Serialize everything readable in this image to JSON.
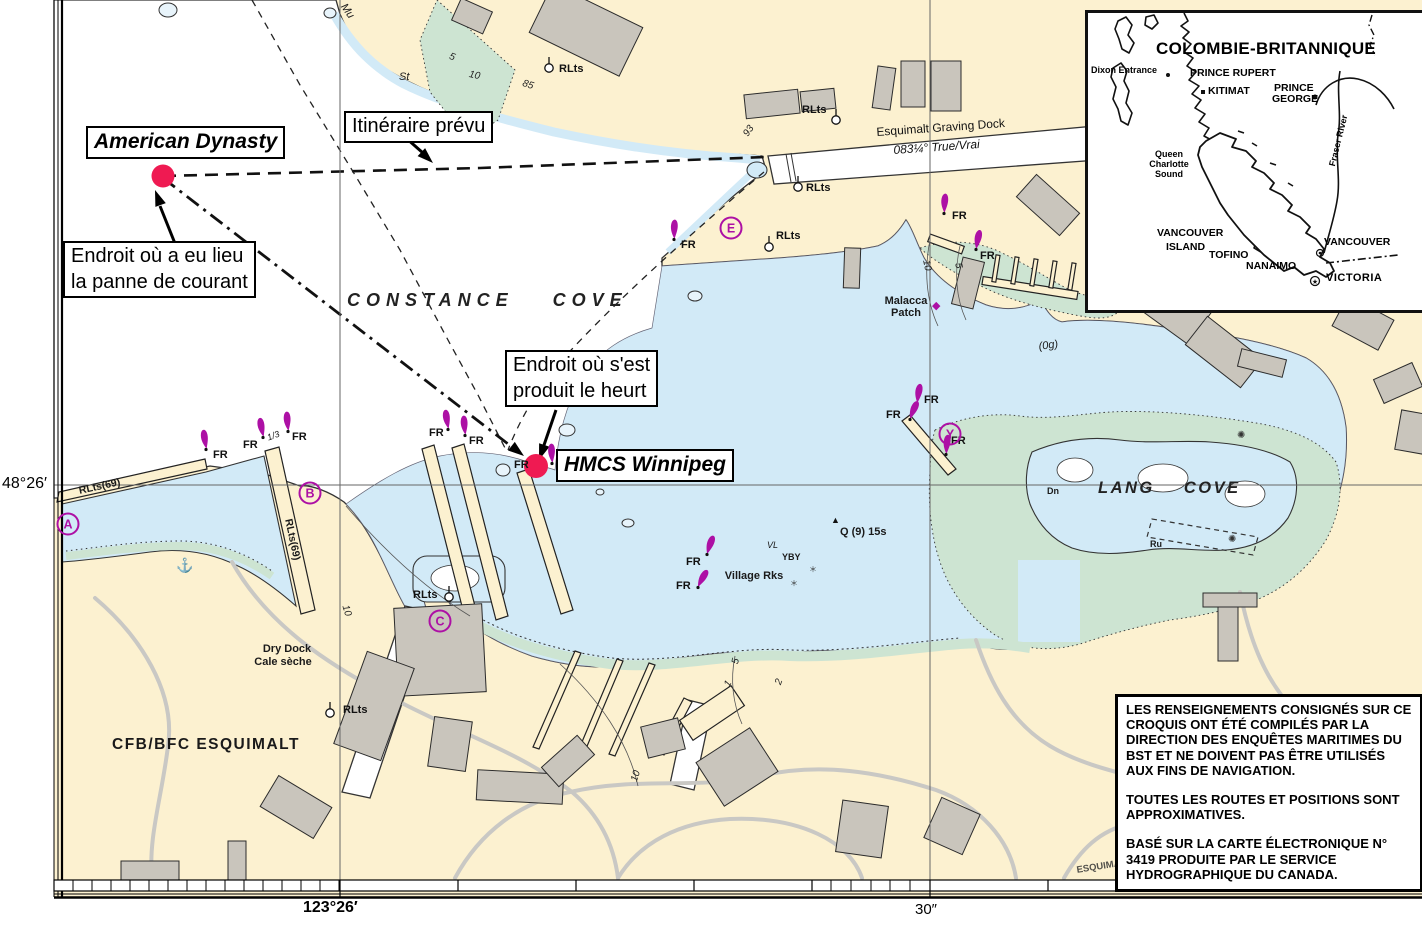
{
  "colors": {
    "land": "#fcf1d0",
    "water_deep": "#ffffff",
    "water_shallow": "#d2eaf7",
    "tidal_green": "#cde4d2",
    "building": "#c9c5bc",
    "road": "#c9c8c4",
    "magenta": "#ad10a5",
    "incident_red": "#ef1a52",
    "ink": "#111111"
  },
  "annotations": {
    "american_dynasty": "American Dynasty",
    "itineraire": "Itinéraire prévu",
    "panne": {
      "line1": "Endroit où a eu lieu",
      "line2": "la panne de courant"
    },
    "heurt": {
      "line1": "Endroit où s'est",
      "line2": "produit le heurt"
    },
    "hmcs": "HMCS Winnipeg"
  },
  "axis": {
    "lat": "48°26′",
    "lon": "123°26′",
    "sec": "30″"
  },
  "map_labels": [
    {
      "t": "CONSTANCE COVE",
      "x": 347,
      "y": 291,
      "cls": "cove1"
    },
    {
      "t": "LANG COVE",
      "x": 1098,
      "y": 480,
      "cls": "cove2"
    },
    {
      "t": "Esquimalt Graving Dock",
      "x": 876,
      "y": 126,
      "cls": "dockname",
      "rot": -4
    },
    {
      "t": "083¼°  True/Vrai",
      "x": 893,
      "y": 144,
      "cls": "dockbear",
      "rot": -4
    },
    {
      "t": "Malacca",
      "x": 906,
      "y": 296,
      "cls": "sb",
      "c": 1
    },
    {
      "t": "Patch",
      "x": 906,
      "y": 308,
      "cls": "sb",
      "c": 1
    },
    {
      "t": "Village Rks",
      "x": 754,
      "y": 571,
      "cls": "sb",
      "c": 1
    },
    {
      "t": "Q (9) 15s",
      "x": 840,
      "y": 527,
      "cls": "sb",
      "rot": 0
    },
    {
      "t": "VL",
      "x": 767,
      "y": 541,
      "cls": "ti"
    },
    {
      "t": "YBY",
      "x": 782,
      "y": 553,
      "cls": "tiny"
    },
    {
      "t": "Dry Dock",
      "x": 287,
      "y": 644,
      "cls": "sb",
      "c": 1
    },
    {
      "t": "Cale sèche",
      "x": 283,
      "y": 657,
      "cls": "sb",
      "c": 1
    },
    {
      "t": "CFB/BFC ESQUIMALT",
      "x": 112,
      "y": 737,
      "cls": "base"
    },
    {
      "t": "Dn",
      "x": 1047,
      "y": 487,
      "cls": "tiny"
    },
    {
      "t": "Ru",
      "x": 1150,
      "y": 540,
      "cls": "tiny"
    },
    {
      "t": "Mu",
      "x": 347,
      "y": 2,
      "cls": "si",
      "rot": 55
    },
    {
      "t": "St",
      "x": 399,
      "y": 72,
      "cls": "si"
    },
    {
      "t": "G",
      "x": 430,
      "y": 114,
      "cls": "si"
    },
    {
      "t": "(0g)",
      "x": 1038,
      "y": 342,
      "cls": "si",
      "rot": -8
    },
    {
      "t": "5",
      "x": 451,
      "y": 52,
      "cls": "depth",
      "rot": 20
    },
    {
      "t": "10",
      "x": 470,
      "y": 70,
      "cls": "depth",
      "rot": 12
    },
    {
      "t": "85",
      "x": 524,
      "y": 79,
      "cls": "depth",
      "rot": 18
    },
    {
      "t": "93",
      "x": 742,
      "y": 133,
      "cls": "depth",
      "rot": -55
    },
    {
      "t": "10",
      "x": 349,
      "y": 604,
      "cls": "depth",
      "rot": 72
    },
    {
      "t": "10",
      "x": 630,
      "y": 780,
      "cls": "depth",
      "rot": -72
    },
    {
      "t": "5",
      "x": 731,
      "y": 663,
      "cls": "depth",
      "rot": -78
    },
    {
      "t": "1",
      "x": 723,
      "y": 684,
      "cls": "depth",
      "rot": -60
    },
    {
      "t": "2",
      "x": 774,
      "y": 683,
      "cls": "depth",
      "rot": -70
    },
    {
      "t": "10",
      "x": 930,
      "y": 259,
      "cls": "depth",
      "rot": 78
    },
    {
      "t": "5",
      "x": 962,
      "y": 262,
      "cls": "depth",
      "rot": 78
    },
    {
      "t": "RLts(69)",
      "x": 78,
      "y": 486,
      "cls": "rltsrot",
      "rot": -12
    },
    {
      "t": "RLts(69)",
      "x": 293,
      "y": 518,
      "cls": "rltsrot",
      "rot": 78
    },
    {
      "t": "1/3",
      "x": 266,
      "y": 434,
      "cls": "ti",
      "rot": -20
    },
    {
      "t": "ESQUIMALT RD",
      "x": 1076,
      "y": 866,
      "cls": "roadlbl",
      "rot": -9
    }
  ],
  "beacons": [
    {
      "label": "FR",
      "x": 206,
      "y": 448,
      "rot": -10,
      "lx": 213,
      "ly": 458
    },
    {
      "label": "FR",
      "x": 263,
      "y": 436,
      "rot": -12,
      "lx": 243,
      "ly": 448
    },
    {
      "label": "FR",
      "x": 288,
      "y": 430,
      "rot": -6,
      "lx": 292,
      "ly": 440
    },
    {
      "label": "FR",
      "x": 448,
      "y": 428,
      "rot": -10,
      "lx": 429,
      "ly": 436
    },
    {
      "label": "FR",
      "x": 465,
      "y": 434,
      "rot": -6,
      "lx": 469,
      "ly": 444
    },
    {
      "label": "FR",
      "x": 552,
      "y": 462,
      "rot": -4,
      "lx": 514,
      "ly": 468
    },
    {
      "label": "FR",
      "x": 674,
      "y": 238,
      "rot": 0,
      "lx": 681,
      "ly": 248
    },
    {
      "label": "FR",
      "x": 944,
      "y": 212,
      "rot": 2,
      "lx": 952,
      "ly": 219
    },
    {
      "label": "FR",
      "x": 976,
      "y": 248,
      "rot": 10,
      "lx": 980,
      "ly": 259
    },
    {
      "label": "FR",
      "x": 917,
      "y": 402,
      "rot": 8,
      "lx": 924,
      "ly": 403
    },
    {
      "label": "FR",
      "x": 910,
      "y": 418,
      "rot": 22,
      "lx": 886,
      "ly": 418
    },
    {
      "label": "FR",
      "x": 946,
      "y": 453,
      "rot": 4,
      "lx": 951,
      "ly": 444
    },
    {
      "label": "FR",
      "x": 707,
      "y": 553,
      "rot": 18,
      "lx": 686,
      "ly": 565
    },
    {
      "label": "FR",
      "x": 698,
      "y": 586,
      "rot": 28,
      "lx": 676,
      "ly": 589
    }
  ],
  "lights": [
    {
      "label": "RLts",
      "cx": 549,
      "cy": 68,
      "lx": 559,
      "ly": 64
    },
    {
      "label": "RLts",
      "cx": 836,
      "cy": 120,
      "lx": 802,
      "ly": 105
    },
    {
      "label": "RLts",
      "cx": 798,
      "cy": 187,
      "lx": 806,
      "ly": 183
    },
    {
      "label": "RLts",
      "cx": 769,
      "cy": 247,
      "lx": 776,
      "ly": 231
    },
    {
      "label": "RLts",
      "cx": 449,
      "cy": 597,
      "lx": 413,
      "ly": 590
    },
    {
      "label": "RLts",
      "cx": 330,
      "cy": 713,
      "lx": 343,
      "ly": 705
    }
  ],
  "letter_markers": [
    {
      "letter": "A",
      "x": 68,
      "y": 524
    },
    {
      "letter": "B",
      "x": 310,
      "y": 493
    },
    {
      "letter": "C",
      "x": 440,
      "y": 621
    },
    {
      "letter": "E",
      "x": 731,
      "y": 228
    },
    {
      "letter": "Y",
      "x": 950,
      "y": 434
    }
  ],
  "symbols": [
    {
      "glyph": "⚓",
      "x": 176,
      "y": 556,
      "size": 14,
      "color": "#222"
    },
    {
      "glyph": "◆",
      "x": 932,
      "y": 298,
      "size": 11,
      "color": "#ad10a5"
    },
    {
      "glyph": "✺",
      "x": 1237,
      "y": 428,
      "size": 10,
      "color": "#333"
    },
    {
      "glyph": "✺",
      "x": 1228,
      "y": 532,
      "size": 10,
      "color": "#333"
    },
    {
      "glyph": "＊",
      "x": 790,
      "y": 578,
      "size": 8,
      "color": "#333"
    },
    {
      "glyph": "＊",
      "x": 809,
      "y": 564,
      "size": 8,
      "color": "#333"
    },
    {
      "glyph": "▲",
      "x": 831,
      "y": 514,
      "size": 9,
      "color": "#111"
    }
  ],
  "inset": {
    "title": "COLOMBIE-BRITANNIQUE",
    "labels": [
      {
        "t": "Dixon Entrance",
        "x": 3,
        "y": 53,
        "cls": "i-small"
      },
      {
        "t": "PRINCE RUPERT",
        "x": 102,
        "y": 55,
        "cls": "i-med"
      },
      {
        "t": "KITIMAT",
        "x": 120,
        "y": 73,
        "cls": "i-med"
      },
      {
        "t": "PRINCE",
        "x": 186,
        "y": 70,
        "cls": "i-med"
      },
      {
        "t": "GEORGE",
        "x": 184,
        "y": 81,
        "cls": "i-med"
      },
      {
        "t": "Queen",
        "x": 81,
        "y": 137,
        "cls": "i-small",
        "c": 1
      },
      {
        "t": "Charlotte",
        "x": 81,
        "y": 147,
        "cls": "i-small",
        "c": 1
      },
      {
        "t": "Sound",
        "x": 81,
        "y": 157,
        "cls": "i-small",
        "c": 1
      },
      {
        "t": "VANCOUVER",
        "x": 69,
        "y": 215,
        "cls": "i-med"
      },
      {
        "t": "ISLAND",
        "x": 78,
        "y": 229,
        "cls": "i-med"
      },
      {
        "t": "TOFINO",
        "x": 121,
        "y": 237,
        "cls": "i-med"
      },
      {
        "t": "NANAIMO",
        "x": 158,
        "y": 248,
        "cls": "i-med"
      },
      {
        "t": "VANCOUVER",
        "x": 236,
        "y": 224,
        "cls": "i-med"
      },
      {
        "t": "VICTORIA",
        "x": 238,
        "y": 260,
        "cls": "i-bold"
      },
      {
        "t": "Fraser River",
        "x": 240,
        "y": 152,
        "cls": "i-small",
        "rot": -76
      }
    ]
  },
  "disclaimer": {
    "p1": "LES RENSEIGNEMENTS CONSIGNÉS SUR CE CROQUIS ONT ÉTÉ COMPILÉS PAR LA DIRECTION DES ENQUÊTES MARITIMES DU BST ET NE DOIVENT PAS ÊTRE UTILISÉS AUX FINS DE NAVIGATION.",
    "p2": "TOUTES LES ROUTES ET POSITIONS SONT APPROXIMATIVES.",
    "p3": "BASÉ SUR LA CARTE ÉLECTRONIQUE N° 3419 PRODUITE PAR LE SERVICE HYDROGRAPHIQUE DU CANADA."
  }
}
